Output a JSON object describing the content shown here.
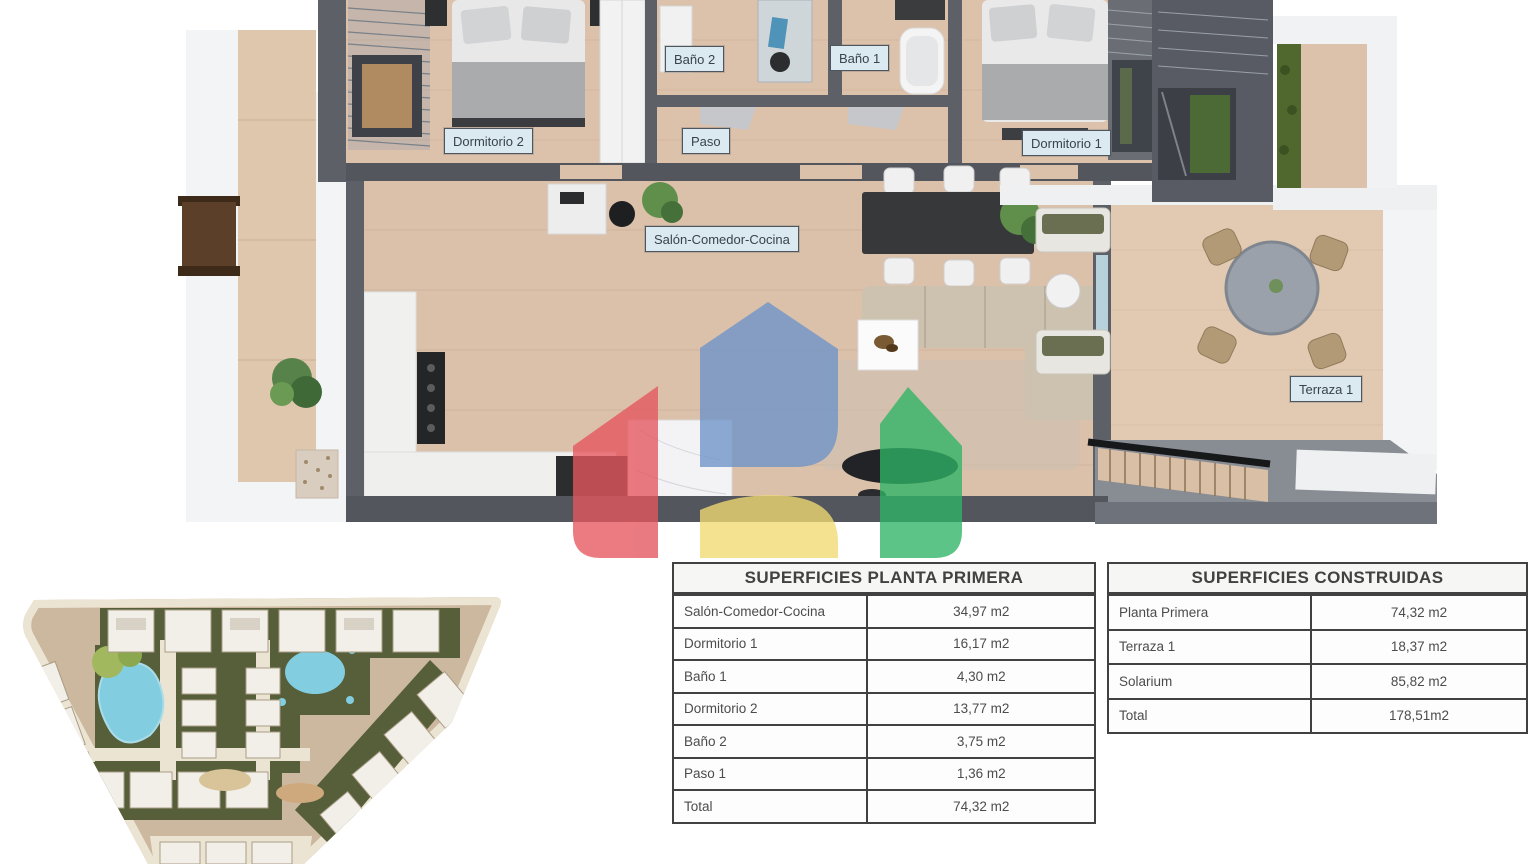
{
  "page": {
    "background": "#ffffff"
  },
  "floor_plan": {
    "room_labels": [
      {
        "key": "bano2",
        "label": "Baño 2"
      },
      {
        "key": "bano1",
        "label": "Baño 1"
      },
      {
        "key": "dormitorio2",
        "label": "Dormitorio 2"
      },
      {
        "key": "paso",
        "label": "Paso"
      },
      {
        "key": "dormitorio1",
        "label": "Dormitorio 1"
      },
      {
        "key": "salon",
        "label": "Salón-Comedor-Cocina"
      },
      {
        "key": "terraza1",
        "label": "Terraza 1"
      }
    ]
  },
  "tables": [
    {
      "title": "SUPERFICIES PLANTA PRIMERA",
      "rows": [
        {
          "label": "Salón-Comedor-Cocina",
          "value": "34,97 m2"
        },
        {
          "label": "Dormitorio 1",
          "value": "16,17 m2"
        },
        {
          "label": "Baño 1",
          "value": "4,30 m2"
        },
        {
          "label": "Dormitorio 2",
          "value": "13,77 m2"
        },
        {
          "label": "Baño 2",
          "value": "3,75 m2"
        },
        {
          "label": "Paso 1",
          "value": "1,36 m2"
        },
        {
          "label": "Total",
          "value": "74,32 m2"
        }
      ]
    },
    {
      "title": "SUPERFICIES CONSTRUIDAS",
      "rows": [
        {
          "label": "Planta Primera",
          "value": "74,32 m2"
        },
        {
          "label": "Terraza 1",
          "value": "18,37 m2"
        },
        {
          "label": "Solarium",
          "value": "85,82 m2"
        },
        {
          "label": "Total",
          "value": "178,51m2"
        }
      ]
    }
  ],
  "watermark": {
    "name": "agency-logo-watermark",
    "colors": {
      "red": "#e5565e",
      "blue": "#6d94c9",
      "yellow": "#f1db72",
      "green": "#2eb465"
    }
  }
}
